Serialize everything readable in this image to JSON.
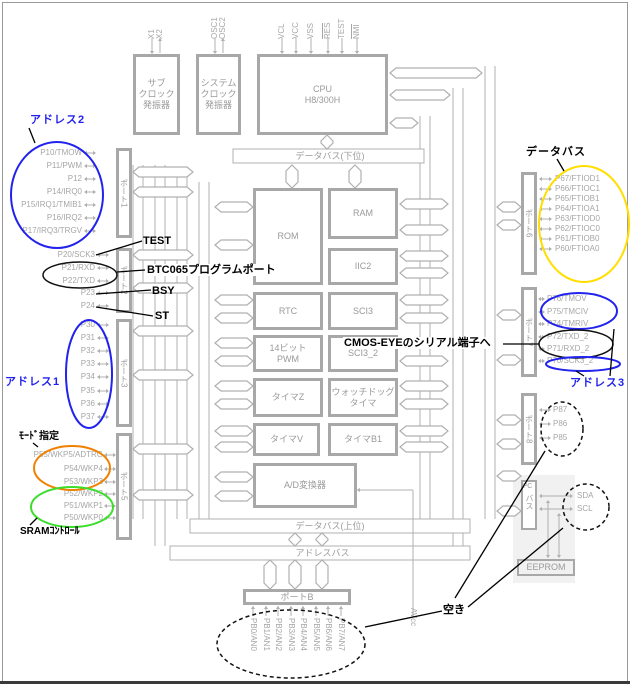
{
  "diagram": {
    "top_pins": [
      "X1",
      "X2",
      "OSC1",
      "OSC2",
      "VCL",
      "VCC",
      "VSS",
      "RES",
      "TEST",
      "NMI"
    ],
    "blocks": {
      "subclock": "サブ\nクロック\n発振器",
      "sysclock": "システム\nクロック\n発振器",
      "cpu": "CPU\nH8/300H",
      "rom": "ROM",
      "ram": "RAM",
      "iic2": "IIC2",
      "rtc": "RTC",
      "sci3": "SCI3",
      "pwm14": "14ビット\nPWM",
      "sci3_2": "SCI3_2",
      "timer_z": "タイマZ",
      "wdt": "ウォッチドッグ\nタイマ",
      "timer_v": "タイマV",
      "timer_b1": "タイマB1",
      "adc": "A/D変換器",
      "eeprom": "EEPROM",
      "i2c_top": "I²C",
      "i2c_body": "バス"
    },
    "ports": {
      "p1": "ポート1",
      "p2": "ポート2",
      "p3": "ポート3",
      "p5": "ポート5",
      "p6": "ポート6",
      "p7": "ポート7",
      "p8": "ポート8",
      "pb": "ポートB"
    },
    "buses": {
      "data_lower": "データバス(下位)",
      "data_upper": "データバス(上位)",
      "address": "アドレスバス"
    },
    "pins": {
      "port1": [
        "P10/TMOW",
        "P11/PWM",
        "P12",
        "P14/IRQ0",
        "P15/IRQ1/TMIB1",
        "P16/IRQ2",
        "P17/IRQ3/TRGV"
      ],
      "port2": [
        "P20/SCK3",
        "P21/RXD",
        "P22/TXD",
        "P23",
        "P24"
      ],
      "port3": [
        "P30",
        "P31",
        "P32",
        "P33",
        "P34",
        "P35",
        "P36",
        "P37"
      ],
      "port5": [
        "P55/WKP5/ADTRG",
        "P54/WKP4",
        "P53/WKP3",
        "P52/WKP2",
        "P51/WKP1",
        "P50/WKP0"
      ],
      "port6": [
        "P67/FTIOD1",
        "P66/FTIOC1",
        "P65/FTIOB1",
        "P64/FTIOA1",
        "P63/FTIOD0",
        "P62/FTIOC0",
        "P61/FTIOB0",
        "P60/FTIOA0"
      ],
      "port7": [
        "P76/TMOV",
        "P75/TMCIV",
        "P74/TMRIV",
        "P72/TXD_2",
        "P71/RXD_2",
        "P70/SCK3_2"
      ],
      "port8": [
        "P87",
        "P86",
        "P85"
      ],
      "i2c": [
        "SDA",
        "SCL"
      ],
      "portb": [
        "PB0/AN0",
        "PB1/AN1",
        "PB2/AN2",
        "PB3/AN3",
        "PB4/AN4",
        "PB5/AN5",
        "PB6/AN6",
        "PB7/AN7"
      ],
      "analog_supply": "AVcc"
    },
    "annotations": {
      "address2": "アドレス2",
      "address1": "アドレス1",
      "address3": "アドレス3",
      "data_bus": "データバス",
      "mode": "ﾓｰﾄﾞ指定",
      "sram": "SRAMｺﾝﾄﾛｰﾙ",
      "test": "TEST",
      "program_port": "BTC065プログラムポート",
      "bsy": "BSY",
      "st": "ST",
      "cmos_eye": "CMOS-EYEのシリアル端子へ",
      "unused": "空き"
    },
    "colors": {
      "address_blue": "#2222ee",
      "databus_yellow": "#ffdf00",
      "mode_orange": "#f08000",
      "sram_green": "#3ddd2d",
      "annotation_black": "#000000",
      "diagram_gray": "#a8a8a8"
    }
  }
}
